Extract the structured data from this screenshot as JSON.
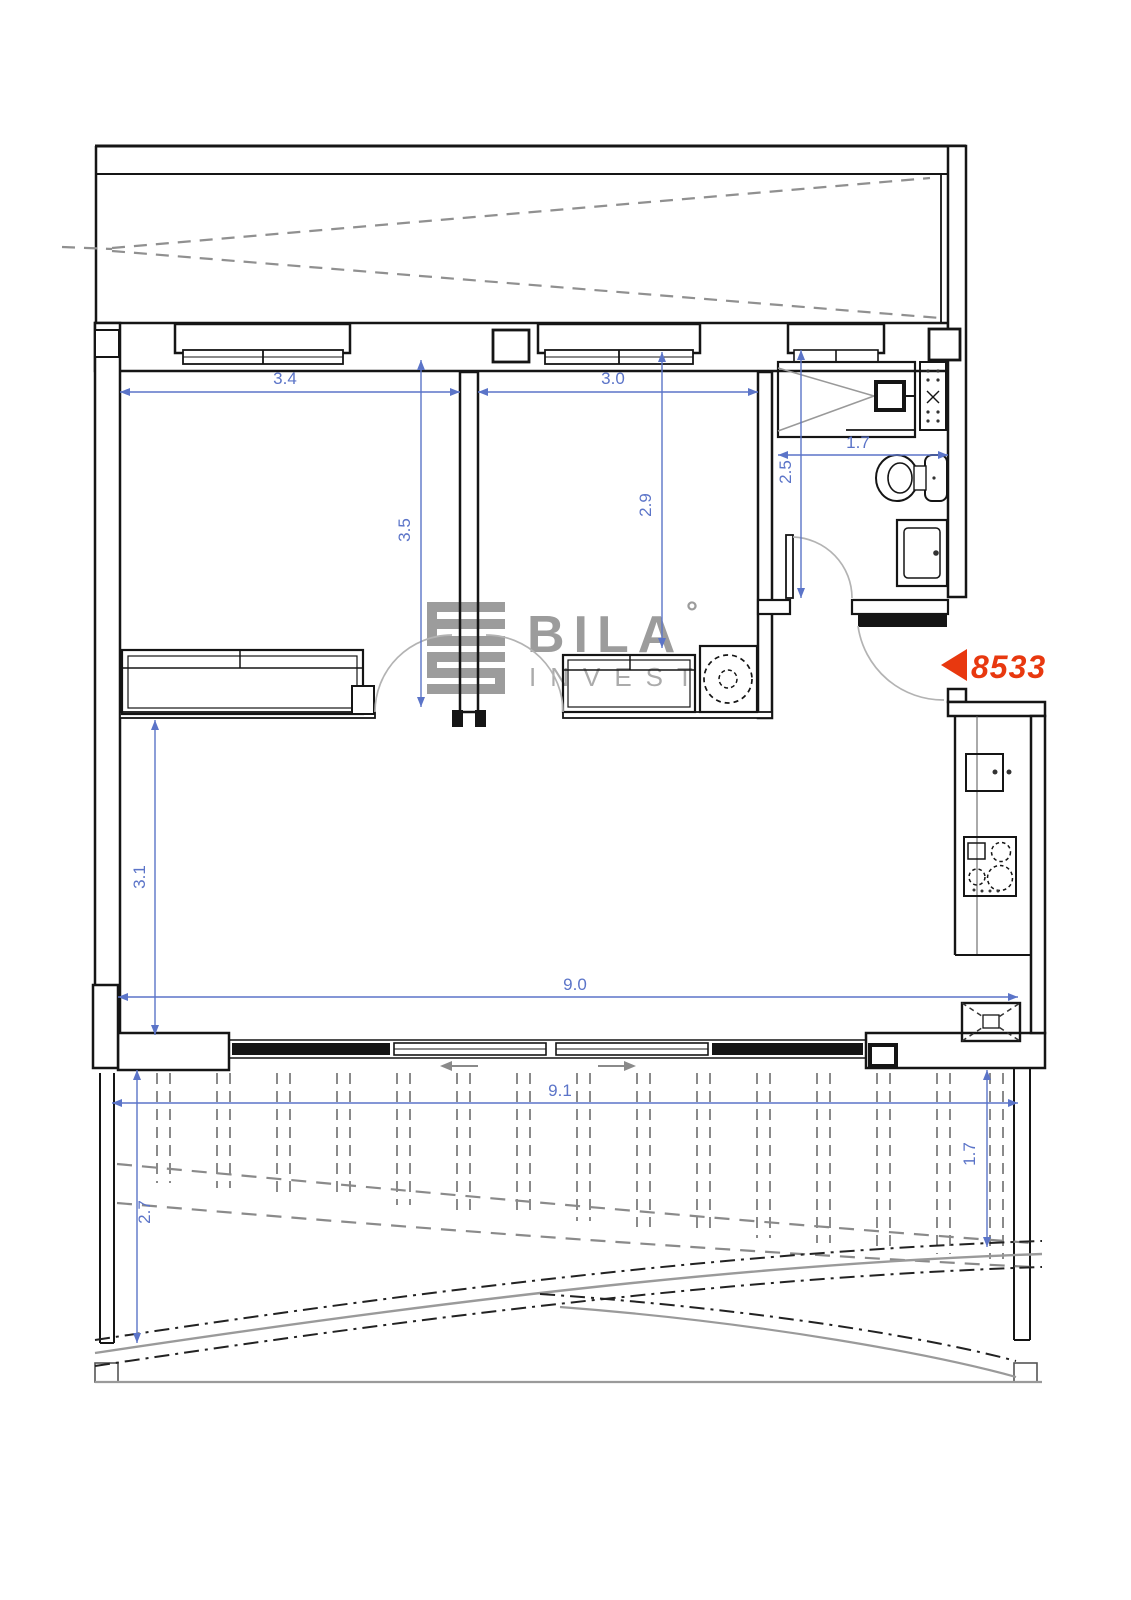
{
  "plan": {
    "watermark": {
      "brand": "BILA",
      "degree_mark": "°",
      "subtitle": "INVEST"
    },
    "unit_marker": {
      "number": "8533"
    },
    "dimensions": {
      "bedroom1_width": "3.4",
      "bedroom1_depth": "3.5",
      "bedroom2_width": "3.0",
      "bedroom2_depth": "2.9",
      "bath_width": "1.7",
      "bath_depth": "2.5",
      "living_depth": "3.1",
      "living_width": "9.0",
      "terrace_width": "9.1",
      "terrace_depth_left": "2.7",
      "terrace_depth_right": "1.7"
    },
    "colors": {
      "dimension_blue": "#5b74c8",
      "marker_red": "#e8380f",
      "wall_black": "#151515",
      "dashed_gray": "#8a8a8a",
      "watermark_gray": "#9c9c9c"
    }
  }
}
